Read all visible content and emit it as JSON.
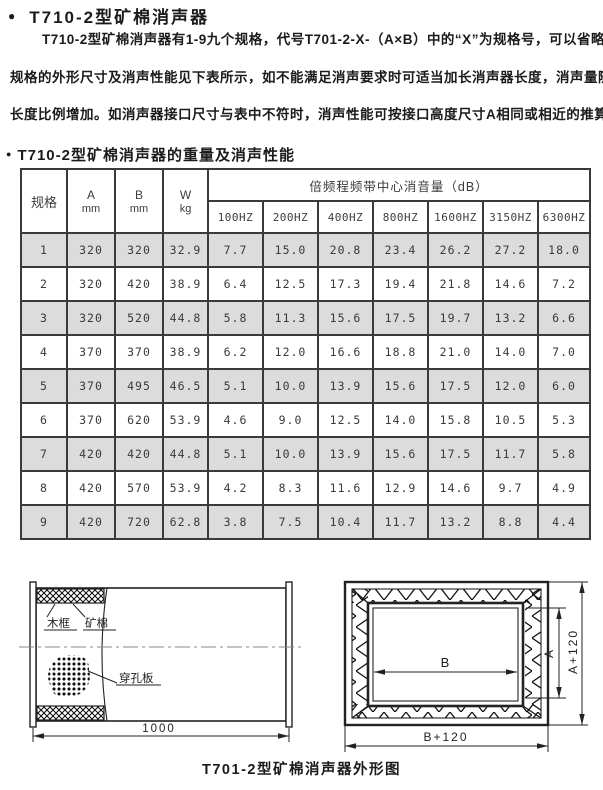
{
  "page": {
    "bullet": "●",
    "title": "T710-2型矿棉消声器",
    "intro_lines": [
      "T710-2型矿棉消声器有1-9九个规格，代号T701-2-X-（A×B）中的“X”为规格号，可以省略，",
      "规格的外形尺寸及消声性能见下表所示，如不能满足消声要求时可适当加长消声器长度，消声量随",
      "长度比例增加。如消声器接口尺寸与表中不符时，消声性能可按接口高度尺寸A相同或相近的推算。"
    ],
    "section2_bullet": "●",
    "section2_title": "T710-2型矿棉消声器的重量及消声性能",
    "caption": "T701-2型矿棉消声器外形图"
  },
  "table": {
    "col_spec": "规格",
    "col_a": "A",
    "col_a_unit": "mm",
    "col_b": "B",
    "col_b_unit": "mm",
    "col_w": "W",
    "col_w_unit": "kg",
    "freq_group": "倍频程频带中心消音量（dB）",
    "freq_cols": [
      "100HZ",
      "200HZ",
      "400HZ",
      "800HZ",
      "1600HZ",
      "3150HZ",
      "6300HZ"
    ],
    "rows": [
      [
        "1",
        "320",
        "320",
        "32.9",
        "7.7",
        "15.0",
        "20.8",
        "23.4",
        "26.2",
        "27.2",
        "18.0"
      ],
      [
        "2",
        "320",
        "420",
        "38.9",
        "6.4",
        "12.5",
        "17.3",
        "19.4",
        "21.8",
        "14.6",
        "7.2"
      ],
      [
        "3",
        "320",
        "520",
        "44.8",
        "5.8",
        "11.3",
        "15.6",
        "17.5",
        "19.7",
        "13.2",
        "6.6"
      ],
      [
        "4",
        "370",
        "370",
        "38.9",
        "6.2",
        "12.0",
        "16.6",
        "18.8",
        "21.0",
        "14.0",
        "7.0"
      ],
      [
        "5",
        "370",
        "495",
        "46.5",
        "5.1",
        "10.0",
        "13.9",
        "15.6",
        "17.5",
        "12.0",
        "6.0"
      ],
      [
        "6",
        "370",
        "620",
        "53.9",
        "4.6",
        "9.0",
        "12.5",
        "14.0",
        "15.8",
        "10.5",
        "5.3"
      ],
      [
        "7",
        "420",
        "420",
        "44.8",
        "5.1",
        "10.0",
        "13.9",
        "15.6",
        "17.5",
        "11.7",
        "5.8"
      ],
      [
        "8",
        "420",
        "570",
        "53.9",
        "4.2",
        "8.3",
        "11.6",
        "12.9",
        "14.6",
        "9.7",
        "4.9"
      ],
      [
        "9",
        "420",
        "720",
        "62.8",
        "3.8",
        "7.5",
        "10.4",
        "11.7",
        "13.2",
        "8.8",
        "4.4"
      ]
    ],
    "shaded_row_color": "#dcdcdc"
  },
  "diagram_left": {
    "label_frame": "木框",
    "label_wool": "矿棉",
    "label_plate": "穿孔板",
    "dim_length": "1000"
  },
  "diagram_right": {
    "dim_b": "B",
    "dim_a": "A",
    "dim_a_plus": "A+120",
    "dim_b_plus": "B+120"
  }
}
